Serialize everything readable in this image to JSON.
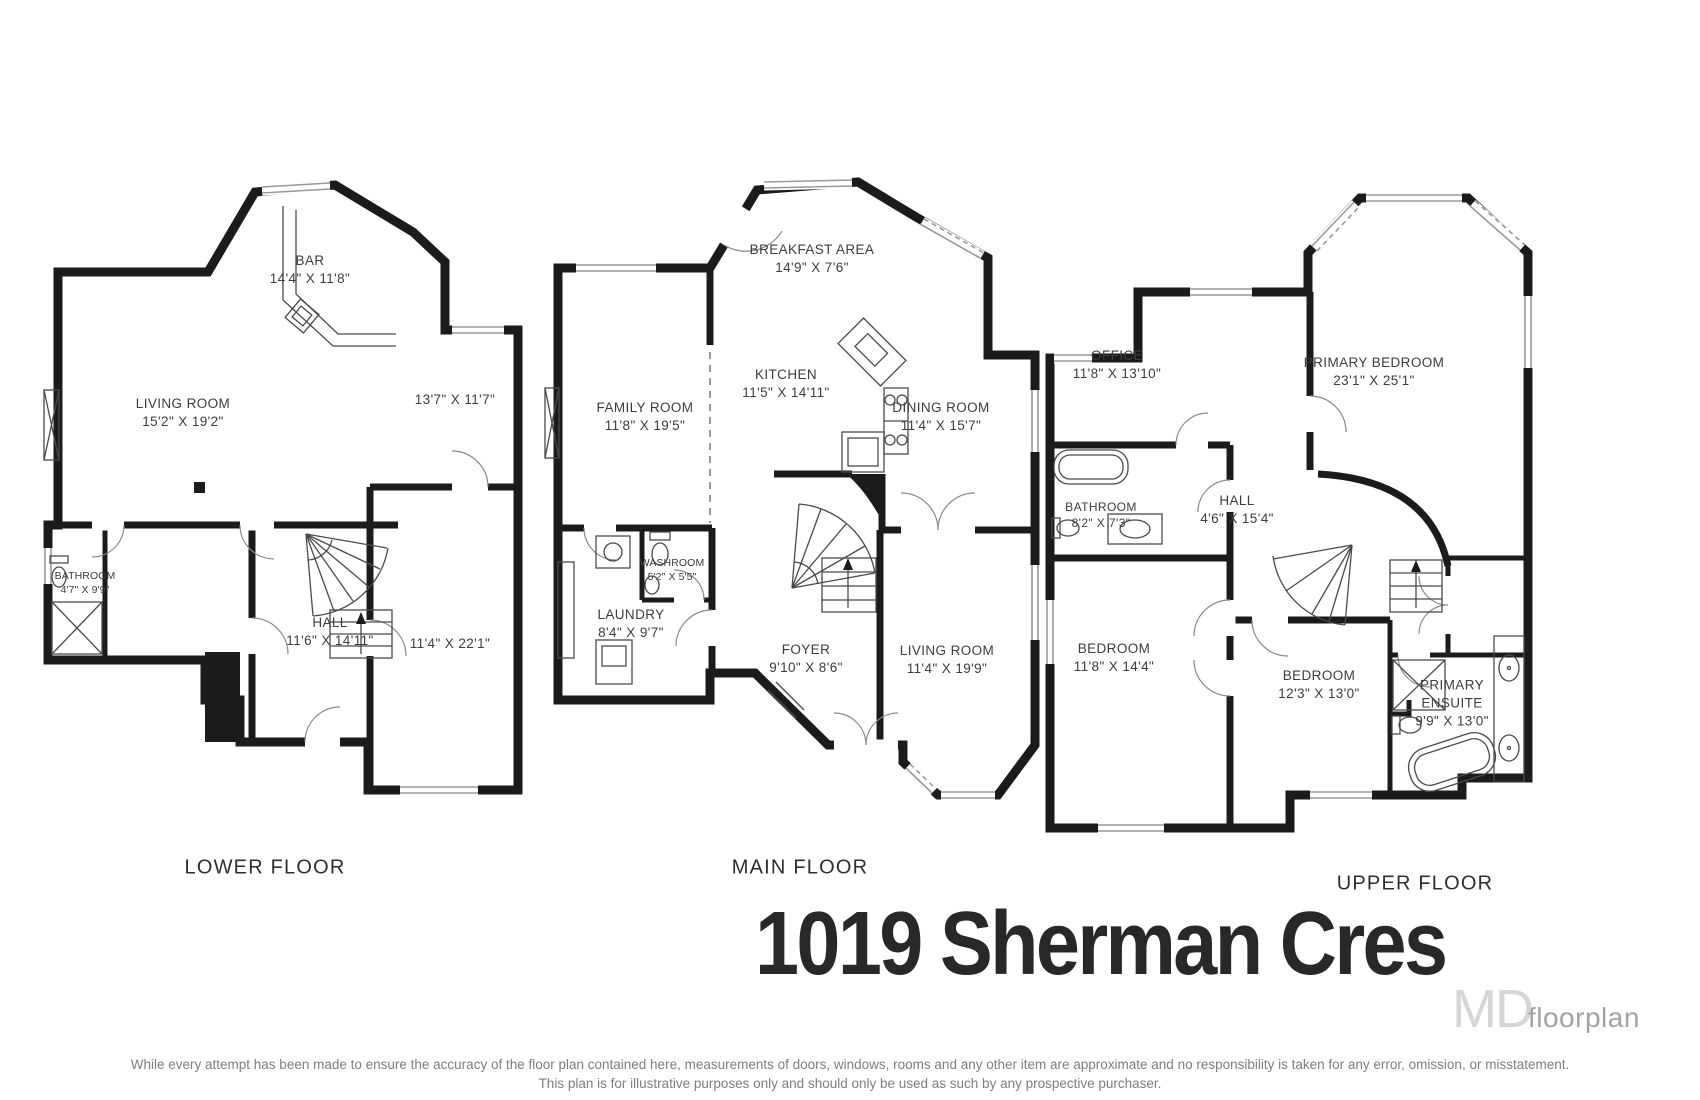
{
  "title": "1019 Sherman Cres",
  "watermark": {
    "logo": "MD",
    "text": "floorplan"
  },
  "disclaimer": {
    "line1": "While every attempt has been made to ensure the accuracy of the floor plan contained here, measurements of doors, windows, rooms and any other item are approximate and no responsibility is taken for any error, omission, or misstatement.",
    "line2": "This plan is for illustrative purposes only and should only be used as such by any prospective purchaser."
  },
  "floors": [
    {
      "name": "LOWER FLOOR",
      "rooms": [
        {
          "label": "BAR",
          "dims": "14'4\" X 11'8\""
        },
        {
          "label": "LIVING ROOM",
          "dims": "15'2\" X 19'2\""
        },
        {
          "label": "",
          "dims": "13'7\" X 11'7\""
        },
        {
          "label": "BATHROOM",
          "dims": "4'7\" X 9'9\""
        },
        {
          "label": "HALL",
          "dims": "11'6\" X 14'11\""
        },
        {
          "label": "",
          "dims": "11'4\" X 22'1\""
        }
      ]
    },
    {
      "name": "MAIN FLOOR",
      "rooms": [
        {
          "label": "BREAKFAST AREA",
          "dims": "14'9\" X 7'6\""
        },
        {
          "label": "FAMILY ROOM",
          "dims": "11'8\" X 19'5\""
        },
        {
          "label": "KITCHEN",
          "dims": "11'5\" X 14'11\""
        },
        {
          "label": "DINING ROOM",
          "dims": "11'4\" X 15'7\""
        },
        {
          "label": "WASHROOM",
          "dims": "5'2\" X 5'5\""
        },
        {
          "label": "LAUNDRY",
          "dims": "8'4\" X 9'7\""
        },
        {
          "label": "FOYER",
          "dims": "9'10\" X 8'6\""
        },
        {
          "label": "LIVING ROOM",
          "dims": "11'4\" X 19'9\""
        }
      ]
    },
    {
      "name": "UPPER FLOOR",
      "rooms": [
        {
          "label": "OFFICE",
          "dims": "11'8\" X 13'10\""
        },
        {
          "label": "PRIMARY BEDROOM",
          "dims": "23'1\" X 25'1\""
        },
        {
          "label": "BATHROOM",
          "dims": "8'2\" X 7'3\""
        },
        {
          "label": "HALL",
          "dims": "4'6\" X 15'4\""
        },
        {
          "label": "BEDROOM",
          "dims": "11'8\" X 14'4\""
        },
        {
          "label": "BEDROOM",
          "dims": "12'3\" X 13'0\""
        },
        {
          "label": "PRIMARY ENSUITE",
          "dims": "9'9\" X 13'0\""
        }
      ]
    }
  ],
  "colors": {
    "wall": "#1b1b1b",
    "label_text": "#3d3d3d",
    "title_text": "#282828",
    "muted": "#7e7e7e"
  }
}
